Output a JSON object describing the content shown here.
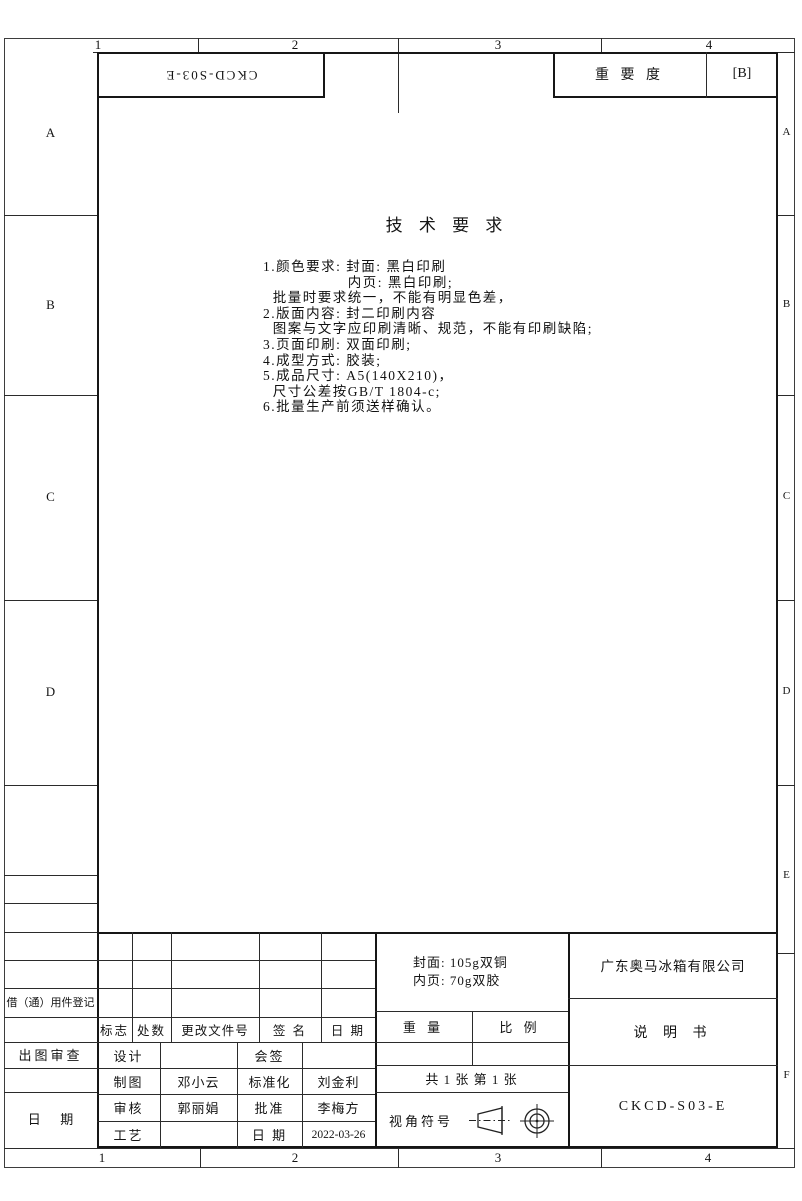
{
  "sheet": {
    "zone_cols_top": {
      "c1": "1",
      "c2": "2",
      "c3": "3",
      "c4": "4"
    },
    "zone_cols_bottom": {
      "c1": "1",
      "c2": "2",
      "c3": "3",
      "c4": "4"
    },
    "zone_rows_left": {
      "rA": "A",
      "rB": "B",
      "rC": "C",
      "rD": "D"
    },
    "zone_rows_right": {
      "rA": "A",
      "rB": "B",
      "rC": "C",
      "rD": "D",
      "rE": "E",
      "rF": "F"
    },
    "doc_code_mirrored": "CKCD-S03-E",
    "importance": {
      "label": "重 要 度",
      "value": "[B]"
    }
  },
  "tech_requirements": {
    "title": "技 术 要 求",
    "lines": [
      "1.颜色要求: 封面: 黑白印刷",
      "　　　　　  内页: 黑白印刷;",
      "  批量时要求统一，不能有明显色差，",
      "2.版面内容: 封二印刷内容",
      "  图案与文字应印刷清晰、规范，不能有印刷缺陷;",
      "3.页面印刷: 双面印刷;",
      "4.成型方式: 胶装;",
      "5.成品尺寸: A5(140X210)，",
      "  尺寸公差按GB/T 1804-c;",
      "6.批量生产前须送样确认。"
    ]
  },
  "margins": {
    "borrow_label": "借（通）用件登记",
    "review_label": "出图审查",
    "date_label": "日      期"
  },
  "title_block": {
    "materials": {
      "cover": "封面: 105g双铜",
      "inner": "内页: 70g双胶"
    },
    "company": "广东奥马冰箱有限公司",
    "doc_title": "说 明 书",
    "doc_code": "CKCD-S03-E",
    "weight_label": "重 量",
    "scale_label": "比 例",
    "sheet_count": "共 1 张 第 1 张",
    "view_symbol_label": "视角符号",
    "revision_header": {
      "mark": "标志",
      "count": "处数",
      "file_no": "更改文件号",
      "signature": "签 名",
      "date": "日 期"
    },
    "signoff": {
      "design_label": "设计",
      "countersign_label": "会签",
      "draft_label": "制图",
      "draft_name": "邓小云",
      "standard_label": "标准化",
      "standard_name": "刘金利",
      "check_label": "审核",
      "check_name": "郭丽娟",
      "approve_label": "批准",
      "approve_name": "李梅方",
      "craft_label": "工艺",
      "date_label": "日 期",
      "date_value": "2022-03-26"
    }
  }
}
